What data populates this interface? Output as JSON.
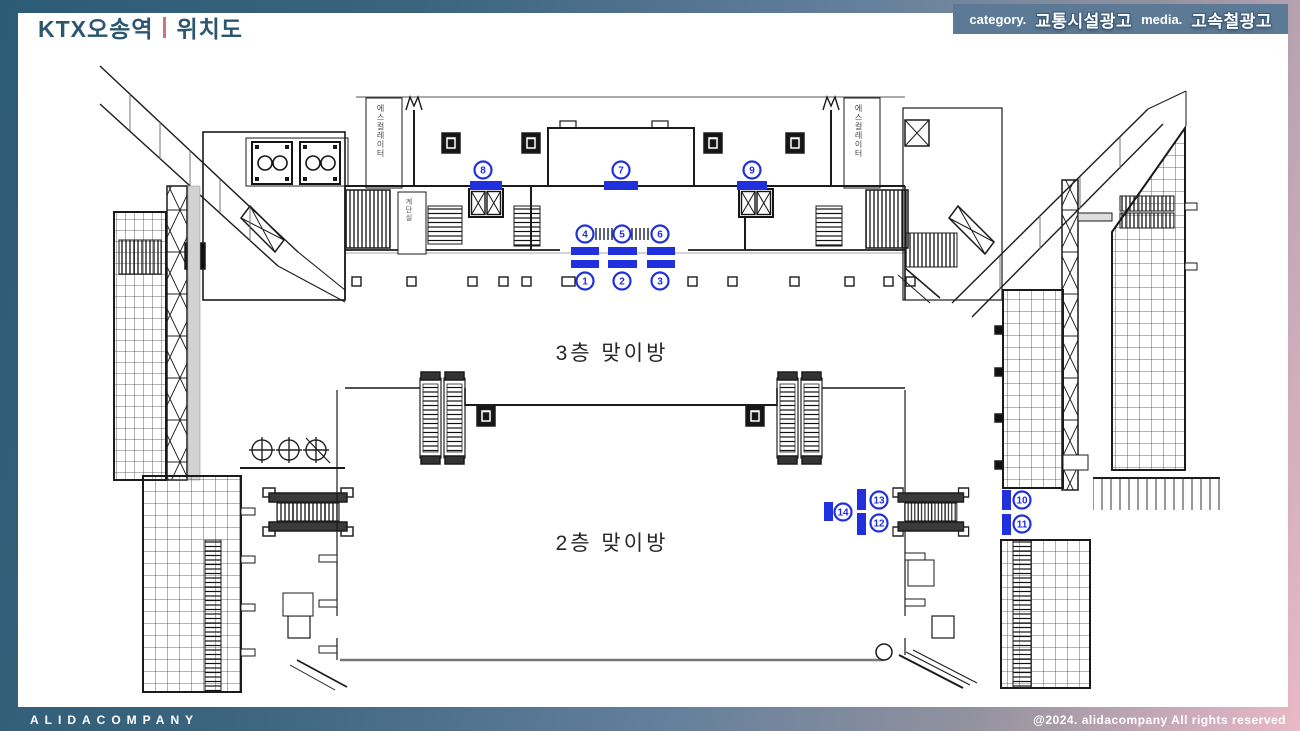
{
  "header": {
    "title": "KTX오송역",
    "subtitle": "위치도",
    "category_label": "category.",
    "category_value": "교통시설광고",
    "media_label": "media.",
    "media_value": "고속철광고"
  },
  "plan": {
    "floor3_label": "3층 맞이방",
    "floor2_label": "2층 맞이방",
    "left_core_label": "에스컬레이터",
    "right_core_label": "에스컬레이터",
    "stair_room_label": "계단실",
    "marker_color": "#2030dd",
    "markers": [
      {
        "num": "1",
        "cx": 585,
        "cy": 281
      },
      {
        "num": "2",
        "cx": 622,
        "cy": 281
      },
      {
        "num": "3",
        "cx": 660,
        "cy": 281
      },
      {
        "num": "4",
        "cx": 585,
        "cy": 234
      },
      {
        "num": "5",
        "cx": 622,
        "cy": 234
      },
      {
        "num": "6",
        "cx": 660,
        "cy": 234
      },
      {
        "num": "7",
        "cx": 621,
        "cy": 170
      },
      {
        "num": "8",
        "cx": 483,
        "cy": 170
      },
      {
        "num": "9",
        "cx": 752,
        "cy": 170
      },
      {
        "num": "10",
        "cx": 1022,
        "cy": 500
      },
      {
        "num": "11",
        "cx": 1022,
        "cy": 524
      },
      {
        "num": "12",
        "cx": 879,
        "cy": 523
      },
      {
        "num": "13",
        "cx": 879,
        "cy": 500
      },
      {
        "num": "14",
        "cx": 843,
        "cy": 512
      }
    ],
    "bars": [
      {
        "x": 470,
        "y": 181,
        "w": 32,
        "h": 9
      },
      {
        "x": 604,
        "y": 181,
        "w": 34,
        "h": 9
      },
      {
        "x": 737,
        "y": 181,
        "w": 30,
        "h": 9
      },
      {
        "x": 571,
        "y": 247,
        "w": 28,
        "h": 8
      },
      {
        "x": 571,
        "y": 260,
        "w": 28,
        "h": 8
      },
      {
        "x": 608,
        "y": 247,
        "w": 29,
        "h": 8
      },
      {
        "x": 608,
        "y": 260,
        "w": 29,
        "h": 8
      },
      {
        "x": 647,
        "y": 247,
        "w": 28,
        "h": 8
      },
      {
        "x": 647,
        "y": 260,
        "w": 28,
        "h": 8
      },
      {
        "x": 824,
        "y": 502,
        "w": 9,
        "h": 19
      },
      {
        "x": 857,
        "y": 489,
        "w": 9,
        "h": 21
      },
      {
        "x": 857,
        "y": 513,
        "w": 9,
        "h": 22
      },
      {
        "x": 1002,
        "y": 490,
        "w": 9,
        "h": 20
      },
      {
        "x": 1002,
        "y": 514,
        "w": 9,
        "h": 21
      }
    ]
  },
  "footer": {
    "company": "ALIDACOMPANY",
    "copyright": "@2024. alidacompany All rights reserved"
  },
  "colors": {
    "frame_teal": "#2c5b76",
    "frame_pink": "#eab9c7",
    "title_navy": "#2b566f",
    "divider_pink": "#d4717f",
    "category_box": "#5c7a96",
    "marker_blue": "#2030dd"
  }
}
